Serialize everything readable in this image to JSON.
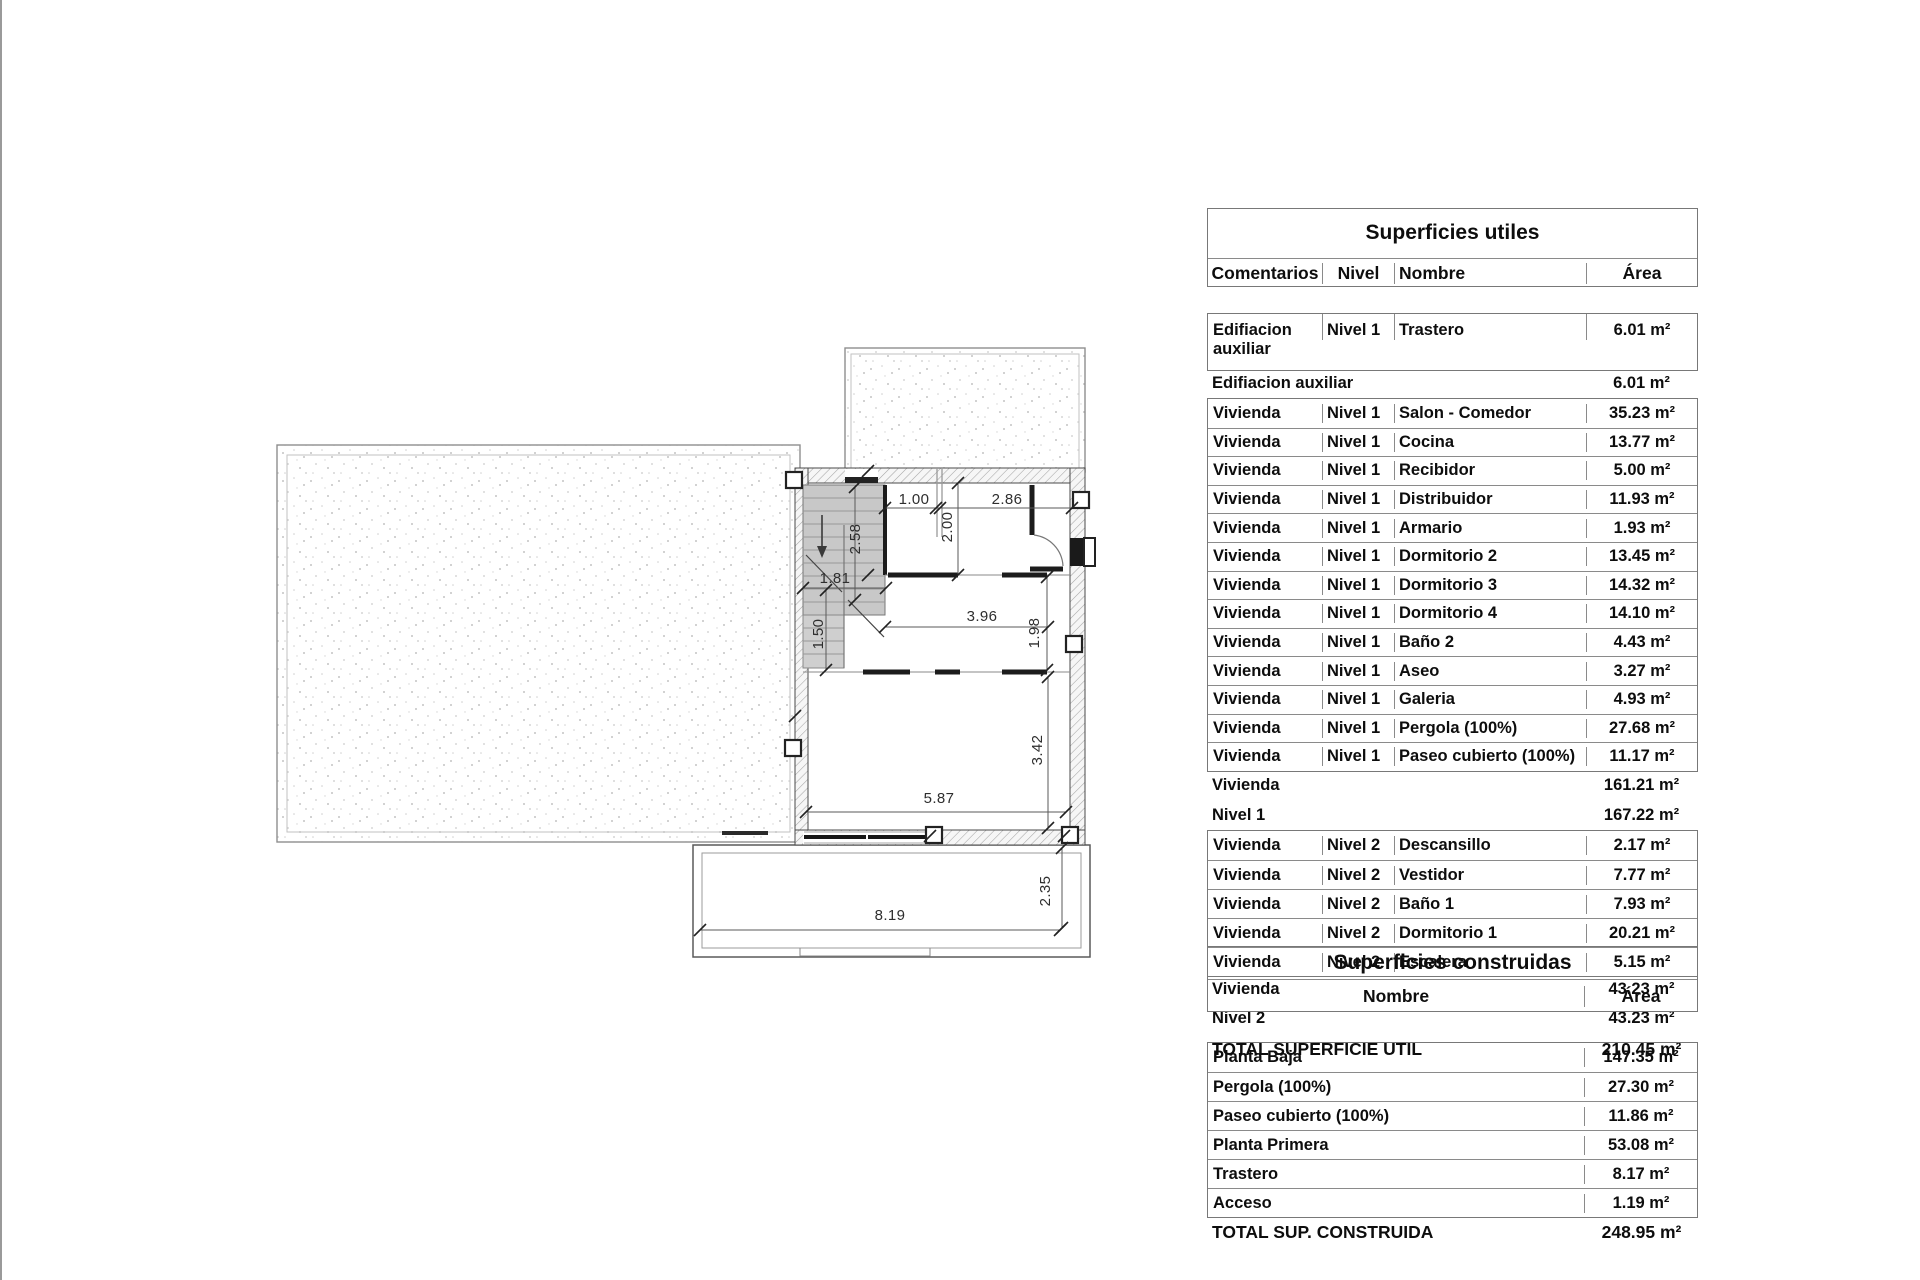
{
  "plan": {
    "dims": {
      "d100": "1.00",
      "d286": "2.86",
      "d200": "2.00",
      "d258": "2.58",
      "d181": "1.81",
      "d396": "3.96",
      "d198": "1.98",
      "d150": "1.50",
      "d342": "3.42",
      "d587": "5.87",
      "d819": "8.19",
      "d235": "2.35"
    }
  },
  "tables": {
    "utiles": {
      "title": "Superficies utiles",
      "columns": {
        "comments": "Comentarios",
        "level": "Nivel",
        "name": "Nombre",
        "area": "Área"
      },
      "group1": [
        {
          "c": "Edifiacion auxiliar",
          "l": "Nivel 1",
          "n": "Trastero",
          "a": "6.01 m²"
        }
      ],
      "summary1": {
        "label": "Edifiacion auxiliar",
        "area": "6.01 m²"
      },
      "group2": [
        {
          "c": "Vivienda",
          "l": "Nivel 1",
          "n": "Salon - Comedor",
          "a": "35.23 m²"
        },
        {
          "c": "Vivienda",
          "l": "Nivel 1",
          "n": "Cocina",
          "a": "13.77 m²"
        },
        {
          "c": "Vivienda",
          "l": "Nivel 1",
          "n": "Recibidor",
          "a": "5.00 m²"
        },
        {
          "c": "Vivienda",
          "l": "Nivel 1",
          "n": "Distribuidor",
          "a": "11.93 m²"
        },
        {
          "c": "Vivienda",
          "l": "Nivel 1",
          "n": "Armario",
          "a": "1.93 m²"
        },
        {
          "c": "Vivienda",
          "l": "Nivel 1",
          "n": "Dormitorio 2",
          "a": "13.45 m²"
        },
        {
          "c": "Vivienda",
          "l": "Nivel 1",
          "n": "Dormitorio 3",
          "a": "14.32 m²"
        },
        {
          "c": "Vivienda",
          "l": "Nivel 1",
          "n": "Dormitorio 4",
          "a": "14.10 m²"
        },
        {
          "c": "Vivienda",
          "l": "Nivel 1",
          "n": "Baño 2",
          "a": "4.43 m²"
        },
        {
          "c": "Vivienda",
          "l": "Nivel 1",
          "n": "Aseo",
          "a": "3.27 m²"
        },
        {
          "c": "Vivienda",
          "l": "Nivel 1",
          "n": "Galeria",
          "a": "4.93 m²"
        },
        {
          "c": "Vivienda",
          "l": "Nivel 1",
          "n": "Pergola (100%)",
          "a": "27.68 m²"
        },
        {
          "c": "Vivienda",
          "l": "Nivel 1",
          "n": "Paseo cubierto (100%)",
          "a": "11.17 m²"
        }
      ],
      "summary2a": {
        "label": "Vivienda",
        "area": "161.21 m²"
      },
      "summary2b": {
        "label": "Nivel 1",
        "area": "167.22 m²"
      },
      "group3": [
        {
          "c": "Vivienda",
          "l": "Nivel 2",
          "n": "Descansillo",
          "a": "2.17 m²"
        },
        {
          "c": "Vivienda",
          "l": "Nivel 2",
          "n": "Vestidor",
          "a": "7.77 m²"
        },
        {
          "c": "Vivienda",
          "l": "Nivel 2",
          "n": "Baño 1",
          "a": "7.93 m²"
        },
        {
          "c": "Vivienda",
          "l": "Nivel 2",
          "n": "Dormitorio 1",
          "a": "20.21 m²"
        },
        {
          "c": "Vivienda",
          "l": "Nivel 2",
          "n": "Escalera",
          "a": "5.15 m²"
        }
      ],
      "summary3a": {
        "label": "Vivienda",
        "area": "43.23 m²"
      },
      "summary3b": {
        "label": "Nivel 2",
        "area": "43.23 m²"
      },
      "total": {
        "label": "TOTAL SUPERFICIE UTIL",
        "area": "210.45 m²"
      }
    },
    "construidas": {
      "title": "Superficies construidas",
      "columns": {
        "name": "Nombre",
        "area": "Área"
      },
      "rows": [
        {
          "n": "Planta Baja",
          "a": "147.35 m²"
        },
        {
          "n": "Pergola (100%)",
          "a": "27.30 m²"
        },
        {
          "n": "Paseo cubierto (100%)",
          "a": "11.86 m²"
        },
        {
          "n": "Planta Primera",
          "a": "53.08 m²"
        },
        {
          "n": "Trastero",
          "a": "8.17 m²"
        },
        {
          "n": "Acceso",
          "a": "1.19 m²"
        }
      ],
      "total": {
        "label": "TOTAL SUP. CONSTRUIDA",
        "area": "248.95 m²"
      }
    }
  }
}
